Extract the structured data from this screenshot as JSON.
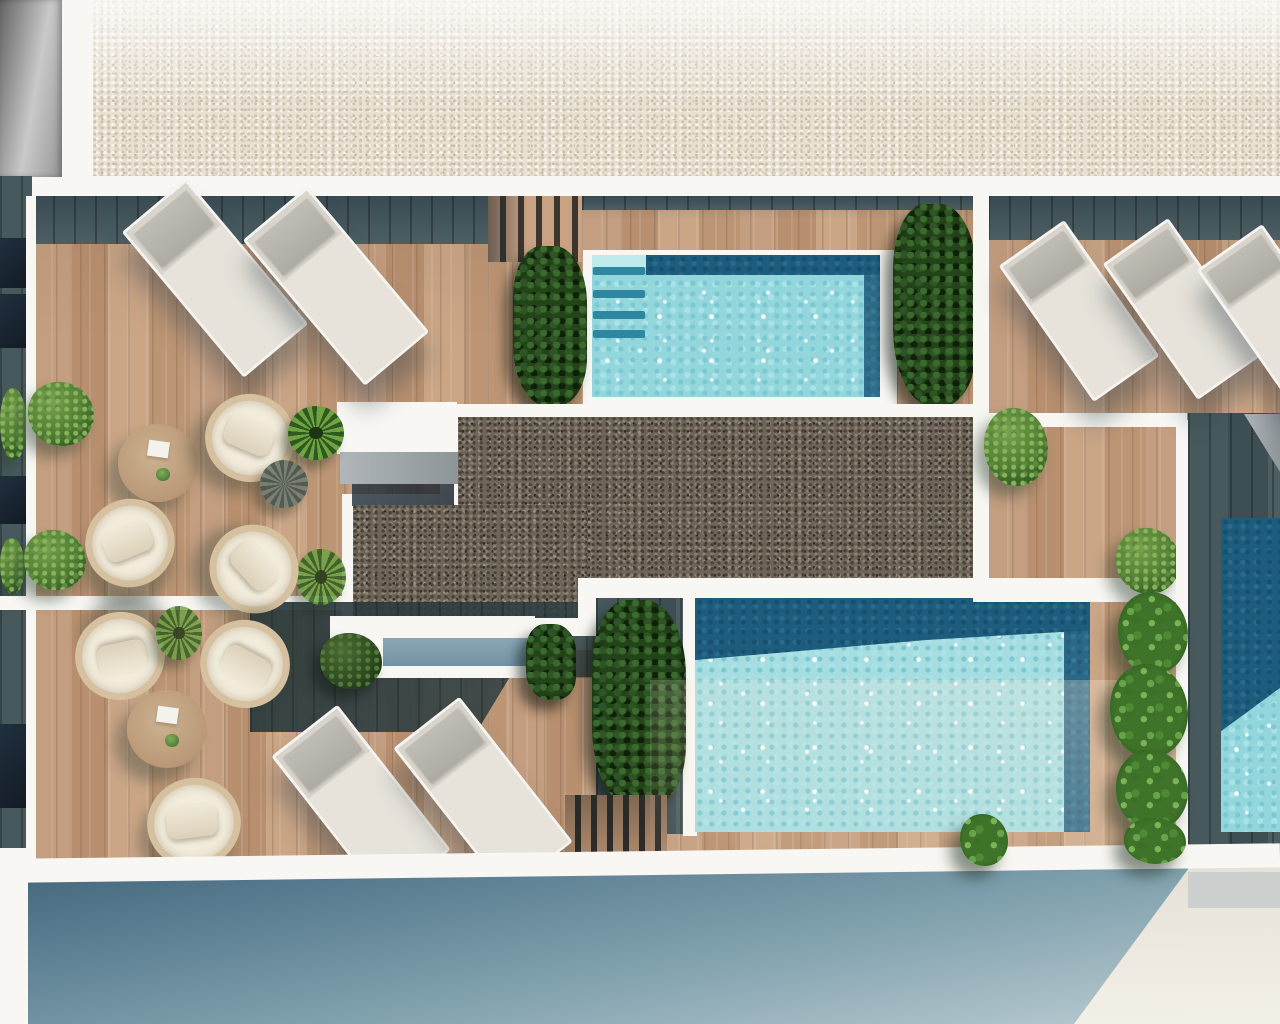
{
  "scene": {
    "canvas": {
      "w": 1280,
      "h": 1024
    },
    "palette": {
      "white": "#f8f7f3",
      "wood": "#c09a7c",
      "woodDark": "#44565a",
      "gravelLight": "#e8e1d4",
      "gravelDark": "#6e6559",
      "waterLight": "#93d6dc",
      "waterDark": "#1e5c7e",
      "accentGreen": "#4d7a33",
      "facadeBlue": "#5d8093"
    },
    "elements": [
      {
        "n": "sky-white-band",
        "t": "white",
        "x": 0,
        "y": 0,
        "w": 1280,
        "h": 198
      },
      {
        "n": "left-wall-edge",
        "t": "wall",
        "x": 0,
        "y": 0,
        "w": 62,
        "h": 177
      },
      {
        "n": "rooftop-gravel-field",
        "t": "gravel-light",
        "x": 93,
        "y": 0,
        "w": 1187,
        "h": 176
      },
      {
        "n": "main-deck-west",
        "t": "wood",
        "x": 32,
        "y": 196,
        "w": 944,
        "h": 668
      },
      {
        "n": "main-deck-east",
        "t": "wood",
        "x": 988,
        "y": 196,
        "w": 292,
        "h": 668
      },
      {
        "n": "shade-band-west",
        "t": "shadowband",
        "x": 32,
        "y": 196,
        "w": 458,
        "h": 48
      },
      {
        "n": "shade-band-pool",
        "t": "shadowband",
        "x": 582,
        "y": 196,
        "w": 394,
        "h": 14
      },
      {
        "n": "shade-band-east",
        "t": "shadowband",
        "x": 988,
        "y": 196,
        "w": 292,
        "h": 44
      },
      {
        "n": "stairs-upper",
        "t": "stairs",
        "x": 488,
        "y": 196,
        "w": 94,
        "h": 66
      },
      {
        "n": "side-terrace-strip",
        "t": "wood-dark",
        "x": 0,
        "y": 176,
        "w": 32,
        "h": 688
      },
      {
        "n": "side-pergola-1",
        "t": "navy",
        "x": 0,
        "y": 238,
        "w": 30,
        "h": 50
      },
      {
        "n": "side-pergola-2",
        "t": "navy",
        "x": 0,
        "y": 294,
        "w": 30,
        "h": 54
      },
      {
        "n": "side-bush-1",
        "t": "bush",
        "x": 0,
        "y": 388,
        "w": 27,
        "h": 72
      },
      {
        "n": "side-pergola-3",
        "t": "navy",
        "x": 0,
        "y": 476,
        "w": 26,
        "h": 48
      },
      {
        "n": "side-bush-2",
        "t": "bush",
        "x": 0,
        "y": 538,
        "w": 25,
        "h": 56
      },
      {
        "n": "side-pergola-4",
        "t": "navy",
        "x": 0,
        "y": 724,
        "w": 30,
        "h": 84
      },
      {
        "n": "side-divider-wall",
        "t": "white",
        "x": 26,
        "y": 196,
        "w": 10,
        "h": 668
      },
      {
        "n": "pool1-deck-strip",
        "t": "wood",
        "x": 582,
        "y": 210,
        "w": 394,
        "h": 46
      },
      {
        "n": "pool1-border",
        "t": "white",
        "x": 583,
        "y": 250,
        "w": 314,
        "h": 156
      },
      {
        "n": "pool1-water",
        "t": "water-light",
        "x": 592,
        "y": 255,
        "w": 288,
        "h": 142
      },
      {
        "n": "pool1-shade-top",
        "t": "water-dark",
        "x": 646,
        "y": 255,
        "w": 234,
        "h": 20
      },
      {
        "n": "pool1-shade-right",
        "t": "water-dark",
        "x": 864,
        "y": 255,
        "w": 16,
        "h": 142,
        "o": 0.85
      },
      {
        "n": "pool1-step-ledge",
        "t": "step-ledge",
        "x": 592,
        "y": 255,
        "w": 54,
        "h": 12
      },
      {
        "n": "pool1-step-1",
        "t": "pool-step",
        "x": 593,
        "y": 267,
        "w": 52,
        "h": 8
      },
      {
        "n": "pool1-step-2",
        "t": "pool-step",
        "x": 593,
        "y": 290,
        "w": 52,
        "h": 8
      },
      {
        "n": "pool1-step-3",
        "t": "pool-step",
        "x": 593,
        "y": 311,
        "w": 52,
        "h": 8
      },
      {
        "n": "pool1-step-4",
        "t": "pool-step",
        "x": 593,
        "y": 330,
        "w": 52,
        "h": 8
      },
      {
        "n": "pool1-plants-west",
        "t": "plant-dark",
        "x": 513,
        "y": 246,
        "w": 74,
        "h": 160
      },
      {
        "n": "pool1-plants-east",
        "t": "plant-dark",
        "x": 893,
        "y": 204,
        "w": 84,
        "h": 202
      },
      {
        "n": "patio-border-main",
        "t": "white",
        "x": 440,
        "y": 404,
        "w": 537,
        "h": 192
      },
      {
        "n": "patio-platform",
        "t": "white",
        "x": 337,
        "y": 402,
        "w": 120,
        "h": 52
      },
      {
        "n": "patio-border-west",
        "t": "white",
        "x": 342,
        "y": 494,
        "w": 250,
        "h": 156
      },
      {
        "n": "patio-ramp",
        "t": "ramp",
        "x": 340,
        "y": 452,
        "w": 118,
        "h": 32
      },
      {
        "n": "patio-ramp-shadow",
        "t": "navy",
        "x": 352,
        "y": 484,
        "w": 102,
        "h": 22,
        "o": 0.8
      },
      {
        "n": "patio-gravel-main",
        "t": "gravel-dark",
        "x": 458,
        "y": 417,
        "w": 515,
        "h": 166
      },
      {
        "n": "patio-gravel-ext",
        "t": "gravel-dark",
        "x": 353,
        "y": 505,
        "w": 234,
        "h": 115
      },
      {
        "n": "walkway-line-west",
        "t": "white",
        "x": 0,
        "y": 596,
        "w": 347,
        "h": 14
      },
      {
        "n": "lower-deck-shadow",
        "t": "deck-shadow",
        "x": 250,
        "y": 602,
        "w": 412,
        "h": 130,
        "c": "polygon(0 0,100% 0,100% 58%,63% 58%,55% 100%,0 100%)"
      },
      {
        "n": "patio-ext-border-bottom",
        "t": "white",
        "x": 345,
        "y": 618,
        "w": 248,
        "h": 18
      },
      {
        "n": "patio-corner-border",
        "t": "white",
        "x": 578,
        "y": 578,
        "w": 24,
        "h": 58
      },
      {
        "n": "bench-platform",
        "t": "white",
        "x": 330,
        "y": 616,
        "w": 205,
        "h": 62
      },
      {
        "n": "bench-steel-step",
        "t": "steel",
        "x": 383,
        "y": 638,
        "w": 148,
        "h": 28
      },
      {
        "n": "shadow-bush-west",
        "t": "bush-dark",
        "x": 320,
        "y": 633,
        "w": 62,
        "h": 56
      },
      {
        "n": "shadow-bush-east",
        "t": "plant-dark",
        "x": 526,
        "y": 624,
        "w": 50,
        "h": 76
      },
      {
        "n": "shadow-palm",
        "t": "palm",
        "x": 296,
        "y": 549,
        "w": 50,
        "h": 56,
        "o": 0.85
      },
      {
        "n": "pool2-border-top",
        "t": "white",
        "x": 588,
        "y": 578,
        "w": 600,
        "h": 22
      },
      {
        "n": "pool2-shade-deck",
        "t": "wood-dark",
        "x": 596,
        "y": 598,
        "w": 90,
        "h": 236
      },
      {
        "n": "pool2-border-west",
        "t": "white",
        "x": 683,
        "y": 596,
        "w": 14,
        "h": 240
      },
      {
        "n": "pool2-water",
        "t": "water-light2",
        "x": 695,
        "y": 598,
        "w": 395,
        "h": 234
      },
      {
        "n": "pool2-shade-top",
        "t": "water-dark",
        "x": 695,
        "y": 598,
        "w": 395,
        "h": 62,
        "c": "polygon(0 0,100% 0,100% 52%,58% 68%,0 100%)"
      },
      {
        "n": "pool2-shade-right",
        "t": "water-dark",
        "x": 1064,
        "y": 628,
        "w": 26,
        "h": 204,
        "o": 0.9
      },
      {
        "n": "pool2-plants-west",
        "t": "plant-dark",
        "x": 592,
        "y": 600,
        "w": 94,
        "h": 208
      },
      {
        "n": "stairs-lower",
        "t": "stairs-dark",
        "x": 565,
        "y": 795,
        "w": 102,
        "h": 64
      },
      {
        "n": "center-divider-wall",
        "t": "white",
        "x": 973,
        "y": 196,
        "w": 16,
        "h": 406
      },
      {
        "n": "east-walkway-upper",
        "t": "white",
        "x": 985,
        "y": 413,
        "w": 202,
        "h": 14
      },
      {
        "n": "east-walkway-lower",
        "t": "white",
        "x": 985,
        "y": 588,
        "w": 203,
        "h": 14
      },
      {
        "n": "east-bush-1",
        "t": "bush",
        "x": 984,
        "y": 408,
        "w": 64,
        "h": 78
      },
      {
        "n": "east-bush-2",
        "t": "bush",
        "x": 1116,
        "y": 528,
        "w": 64,
        "h": 66
      },
      {
        "n": "east-divider-wall",
        "t": "white",
        "x": 1176,
        "y": 420,
        "w": 12,
        "h": 438
      },
      {
        "n": "east-deck-shaded",
        "t": "wood-dark",
        "x": 1188,
        "y": 413,
        "w": 92,
        "h": 447
      },
      {
        "n": "pool3-water",
        "t": "water-dark",
        "x": 1221,
        "y": 518,
        "w": 59,
        "h": 314
      },
      {
        "n": "pool3-sunlit-water",
        "t": "water-light",
        "x": 1221,
        "y": 688,
        "w": 59,
        "h": 144,
        "c": "polygon(0 30%,100% 0,100% 100%,0 100%)"
      },
      {
        "n": "east-structure-corner",
        "t": "ramp",
        "x": 1244,
        "y": 414,
        "w": 36,
        "h": 58,
        "c": "polygon(100% 0,100% 100%,0 0)"
      },
      {
        "n": "lounger-1",
        "t": "lounger",
        "x": 173,
        "y": 183,
        "w": 78,
        "h": 184,
        "r": -40
      },
      {
        "n": "lounger-2",
        "t": "lounger",
        "x": 294,
        "y": 191,
        "w": 78,
        "h": 184,
        "r": -40
      },
      {
        "n": "bush-topleft",
        "t": "bush",
        "x": 28,
        "y": 382,
        "w": 66,
        "h": 64
      },
      {
        "n": "table-1",
        "t": "table",
        "x": 118,
        "y": 424,
        "w": 80,
        "h": 78
      },
      {
        "n": "chair-1",
        "t": "chair",
        "x": 205,
        "y": 394,
        "w": 76,
        "h": 74,
        "r": 15
      },
      {
        "n": "chair-2",
        "t": "chair",
        "x": 85,
        "y": 499,
        "w": 76,
        "h": 74,
        "r": -30
      },
      {
        "n": "chair-3",
        "t": "chair",
        "x": 209,
        "y": 525,
        "w": 76,
        "h": 74,
        "r": 40
      },
      {
        "n": "bush-midleft",
        "t": "bush",
        "x": 24,
        "y": 530,
        "w": 62,
        "h": 60
      },
      {
        "n": "palm-1",
        "t": "palm",
        "x": 288,
        "y": 406,
        "w": 56,
        "h": 54
      },
      {
        "n": "plant-gray-1",
        "t": "plant-gray",
        "x": 260,
        "y": 460,
        "w": 48,
        "h": 48
      },
      {
        "n": "lounger-5",
        "t": "lounger",
        "x": 1039,
        "y": 228,
        "w": 74,
        "h": 160,
        "r": -35
      },
      {
        "n": "lounger-6",
        "t": "lounger",
        "x": 1143,
        "y": 226,
        "w": 74,
        "h": 160,
        "r": -35
      },
      {
        "n": "lounger-7",
        "t": "lounger",
        "x": 1237,
        "y": 232,
        "w": 74,
        "h": 160,
        "r": -35
      },
      {
        "n": "chair-4",
        "t": "chair",
        "x": 75,
        "y": 612,
        "w": 76,
        "h": 74,
        "r": 160
      },
      {
        "n": "chair-5",
        "t": "chair",
        "x": 200,
        "y": 620,
        "w": 76,
        "h": 74,
        "r": -160
      },
      {
        "n": "table-2",
        "t": "table",
        "x": 127,
        "y": 690,
        "w": 80,
        "h": 78
      },
      {
        "n": "chair-6",
        "t": "chair",
        "x": 147,
        "y": 778,
        "w": 80,
        "h": 76,
        "r": -15
      },
      {
        "n": "palm-2",
        "t": "palm",
        "x": 156,
        "y": 606,
        "w": 46,
        "h": 54,
        "o": 0.8
      },
      {
        "n": "lounger-3",
        "t": "lounger",
        "x": 319,
        "y": 711,
        "w": 78,
        "h": 178,
        "r": -38
      },
      {
        "n": "lounger-4",
        "t": "lounger",
        "x": 441,
        "y": 703,
        "w": 78,
        "h": 178,
        "r": -38
      },
      {
        "n": "sunlit-deck-glow",
        "t": "light-overlay",
        "x": 650,
        "y": 680,
        "w": 530,
        "h": 184
      },
      {
        "n": "vine-1",
        "t": "vine",
        "x": 1118,
        "y": 592,
        "w": 70,
        "h": 82
      },
      {
        "n": "vine-2",
        "t": "vine",
        "x": 1110,
        "y": 664,
        "w": 78,
        "h": 94
      },
      {
        "n": "vine-3",
        "t": "vine",
        "x": 1116,
        "y": 750,
        "w": 72,
        "h": 80
      },
      {
        "n": "facade-shaded",
        "t": "facade",
        "x": 0,
        "y": 866,
        "w": 1280,
        "h": 158
      },
      {
        "n": "facade-sunlit",
        "t": "cream",
        "x": 1056,
        "y": 866,
        "w": 224,
        "h": 158,
        "c": "polygon(60% 0,100% 0,100% 100%,8% 100%)"
      },
      {
        "n": "east-ground",
        "t": "cream",
        "x": 1188,
        "y": 860,
        "w": 92,
        "h": 164
      },
      {
        "n": "east-ground-shade",
        "t": "gray-light",
        "x": 1188,
        "y": 872,
        "w": 92,
        "h": 36
      },
      {
        "n": "parapet",
        "t": "white",
        "x": 24,
        "y": 851,
        "w": 1256,
        "h": 24,
        "r": -0.7
      },
      {
        "n": "corner-white-edge",
        "t": "white",
        "x": 0,
        "y": 848,
        "w": 28,
        "h": 176
      },
      {
        "n": "parapet-plant",
        "t": "vine",
        "x": 960,
        "y": 814,
        "w": 48,
        "h": 52
      },
      {
        "n": "vine-4",
        "t": "vine",
        "x": 1124,
        "y": 818,
        "w": 62,
        "h": 46
      }
    ]
  }
}
